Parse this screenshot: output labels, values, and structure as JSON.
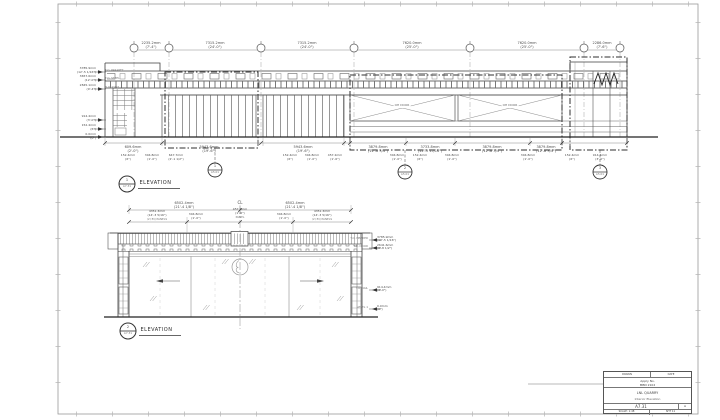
{
  "sheet": {
    "title_block": {
      "r1_left": "DRAWN",
      "r1_right": "DATE",
      "permit_label": "Apply No.",
      "permit_value": "MBN 2102",
      "project": "LNL QUARRY",
      "drawing_title": "Interior Elevation",
      "sheet_number": "A7.31",
      "revision": "A",
      "scale": "SCALE: 1:48",
      "sheet_note": "SHT 11"
    }
  },
  "top_elevation": {
    "view_title": {
      "number": "1",
      "sheet": "A7.31",
      "label": "ELEVATION"
    },
    "grid_dims": [
      {
        "mm": "2235.2mm",
        "ft": "(7'-4\")"
      },
      {
        "mm": "7315.2mm",
        "ft": "(24'-0\")"
      },
      {
        "mm": "7315.2mm",
        "ft": "(24'-0\")"
      },
      {
        "mm": "7620.0mm",
        "ft": "(25'-0\")"
      },
      {
        "mm": "7620.0mm",
        "ft": "(25'-0\")"
      },
      {
        "mm": "2286.0mm",
        "ft": "(7'-6\")"
      }
    ],
    "levels_left": [
      {
        "mm": "3785.9mm",
        "ft": "(12'-5 1/16\")",
        "tag": "T.O. PARAPET"
      },
      {
        "mm": "3657.6mm",
        "ft": "(12'-0\")",
        "tag": "T.O. STEEL"
      },
      {
        "mm": "2845.1mm",
        "ft": "(9'-4\")",
        "tag": "B.O. JOIST"
      },
      {
        "mm": "914.4mm",
        "ft": "(3'-0\")",
        "tag": "T.O. RAIL"
      },
      {
        "mm": "152.4mm",
        "ft": "(6\")",
        "tag": "T.O. CURB"
      },
      {
        "mm": "0.0mm",
        "ft": "(0\")",
        "tag": "LEVEL 1"
      }
    ],
    "bottom_dims": [
      {
        "mm": "609.6mm",
        "ft": "(2'-0\")"
      },
      {
        "mm": "5943.6mm",
        "ft": "(19'-6\")"
      },
      {
        "mm": "5943.6mm",
        "ft": "(19'-6\")"
      },
      {
        "mm": "3879.8mm",
        "ft": "(12'-8 3/4\")"
      },
      {
        "mm": "3733.8mm",
        "ft": "(12'-3 15/16\")"
      },
      {
        "mm": "3879.8mm",
        "ft": "(12'-8 3/4\")"
      },
      {
        "mm": "3879.8mm",
        "ft": "(12'-8 3/4\")"
      }
    ],
    "sub_dims": [
      {
        "mm": "152.4mm",
        "ft": "(6\")"
      },
      {
        "mm": "304.8mm",
        "ft": "(1'-0\")"
      },
      {
        "mm": "647.7mm",
        "ft": "(2'-1 1/2\")"
      },
      {
        "mm": "152.4mm",
        "ft": "(6\")"
      },
      {
        "mm": "304.8mm",
        "ft": "(1'-0\")"
      },
      {
        "mm": "457.2mm",
        "ft": "(1'-6\")"
      },
      {
        "mm": "304.8mm",
        "ft": "(1'-0\")"
      },
      {
        "mm": "152.4mm",
        "ft": "(6\")"
      },
      {
        "mm": "304.8mm",
        "ft": "(1'-0\")"
      },
      {
        "mm": "304.8mm",
        "ft": "(1'-0\")"
      },
      {
        "mm": "152.4mm",
        "ft": "(6\")"
      },
      {
        "mm": "914.4mm",
        "ft": "(3'-0\")"
      }
    ],
    "panel_labels": [
      "OH DOOR",
      "OH DOOR"
    ],
    "callouts": [
      {
        "number": "1",
        "sheet": "A5.01"
      },
      {
        "number": "2",
        "sheet": "A5.01"
      },
      {
        "number": "3",
        "sheet": "A5.01"
      }
    ]
  },
  "bottom_elevation": {
    "view_title": {
      "number": "2",
      "sheet": "A7.31",
      "label": "ELEVATION"
    },
    "centerline_label": "CL",
    "top_dims": [
      {
        "mm": "6502.4mm",
        "ft": "(21'-4 1/8\")"
      },
      {
        "mm": "6502.4mm",
        "ft": "(21'-4 1/8\")"
      }
    ],
    "mid_dims": [
      {
        "mm": "4351.3mm",
        "ft": "(14'-3 5/16\")",
        "note": "(2) EQ PANELS"
      },
      {
        "mm": "304.8mm",
        "ft": "(1'-0\")",
        "note": ""
      },
      {
        "mm": "457.2mm",
        "ft": "(1'-6\")",
        "note": "PANEL"
      },
      {
        "mm": "304.8mm",
        "ft": "(1'-0\")",
        "note": ""
      },
      {
        "mm": "4351.3mm",
        "ft": "(14'-3 5/16\")",
        "note": "(2) EQ PANELS"
      }
    ],
    "levels_right": [
      {
        "mm": "3785.9mm",
        "ft": "(12'-5 1/16\")",
        "tag": "T.O. HEADER"
      },
      {
        "mm": "2641.6mm",
        "ft": "(8'-8 1/2\")",
        "tag": "T.O. DOOR"
      },
      {
        "mm": "914.4mm",
        "ft": "(3'-0\")",
        "tag": "T.O. RAIL"
      },
      {
        "mm": "0.0mm",
        "ft": "(0\")",
        "tag": "LEVEL 1"
      }
    ]
  }
}
